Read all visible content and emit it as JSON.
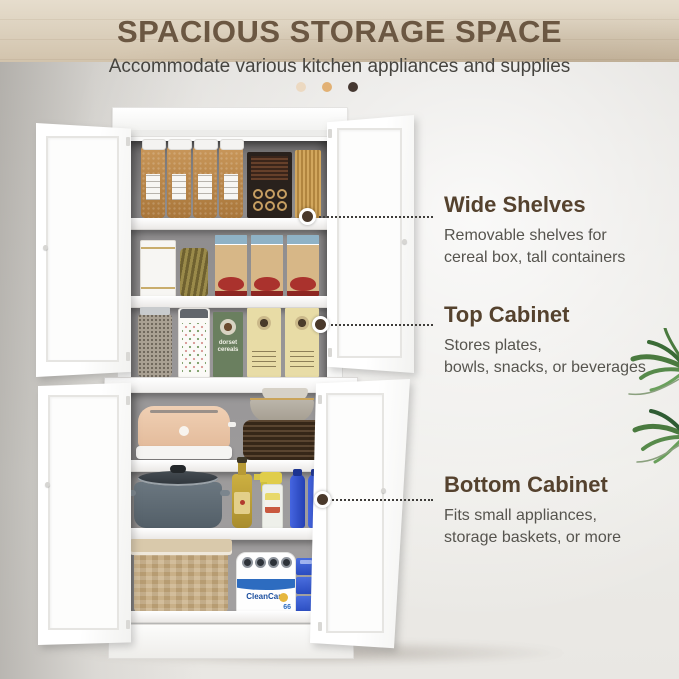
{
  "header": {
    "title": "SPACIOUS STORAGE SPACE",
    "subtitle": "Accommodate various kitchen appliances and supplies",
    "pagination_dots": [
      "#ecd9c1",
      "#e2b174",
      "#453831"
    ]
  },
  "callouts": {
    "wide_shelves": {
      "title": "Wide Shelves",
      "desc": "Removable shelves for\ncereal box, tall containers"
    },
    "top_cabinet": {
      "title": "Top Cabinet",
      "desc": "Stores plates,\nbowls, snacks, or beverages"
    },
    "bottom_cabinet": {
      "title": "Bottom Cabinet",
      "desc": "Fits small appliances,\nstorage baskets, or more"
    }
  },
  "product_labels": {
    "cereal_box": "dorset cereals",
    "paper_towels": "CleanCare",
    "paper_towels_count": "66"
  },
  "colors": {
    "title_brown": "#6b5742",
    "heading_brown": "#55422e",
    "body_text": "#56544e",
    "leader_dot": "#4a392b",
    "cabinet_white": "#fbfbfa",
    "wall_gray": "#e4e2de",
    "floor_wood": "#ddd2bf"
  }
}
